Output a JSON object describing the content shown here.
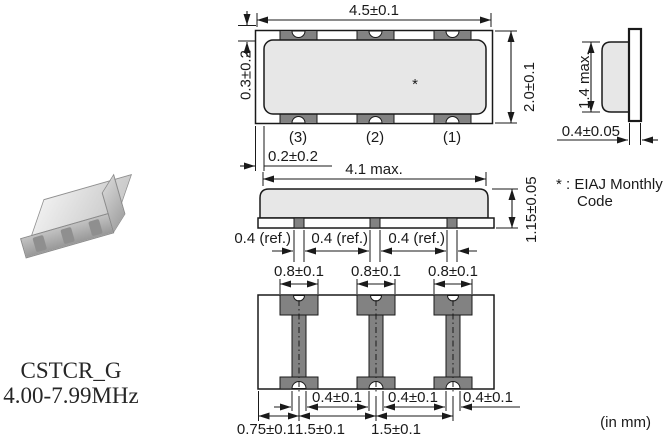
{
  "product": {
    "series": "CSTCR_G",
    "frequency_range": "4.00-7.99MHz"
  },
  "note": {
    "line1": "* : EIAJ Monthly",
    "line2": "Code"
  },
  "units_label": "(in mm)",
  "top_view": {
    "width_dim": "4.5±0.1",
    "height_dim": "2.0±0.1",
    "terminal_overhang_dim": "0.3±0.2",
    "side_margin_dim": "0.2±0.2",
    "marking": "*",
    "terminals": [
      "(3)",
      "(2)",
      "(1)"
    ]
  },
  "side_view": {
    "cap_height_dim": "1.4 max.",
    "substrate_thickness_dim": "0.4±0.05"
  },
  "front_view": {
    "cap_width_dim": "4.1 max.",
    "total_height_dim": "1.15±0.05",
    "electrode_dims": [
      "0.4 (ref.)",
      "0.4 (ref.)",
      "0.4 (ref.)"
    ]
  },
  "bottom_view": {
    "pad_width_dims": [
      "0.8±0.1",
      "0.8±0.1",
      "0.8±0.1"
    ],
    "strip_width_dims": [
      "0.4±0.1",
      "0.4±0.1",
      "0.4±0.1"
    ],
    "pitch_dims": [
      "0.75±0.1",
      "1.5±0.1",
      "1.5±0.1"
    ]
  },
  "colors": {
    "line": "#1a1a1a",
    "body": "#e7e7e7",
    "terminal": "#828282"
  }
}
